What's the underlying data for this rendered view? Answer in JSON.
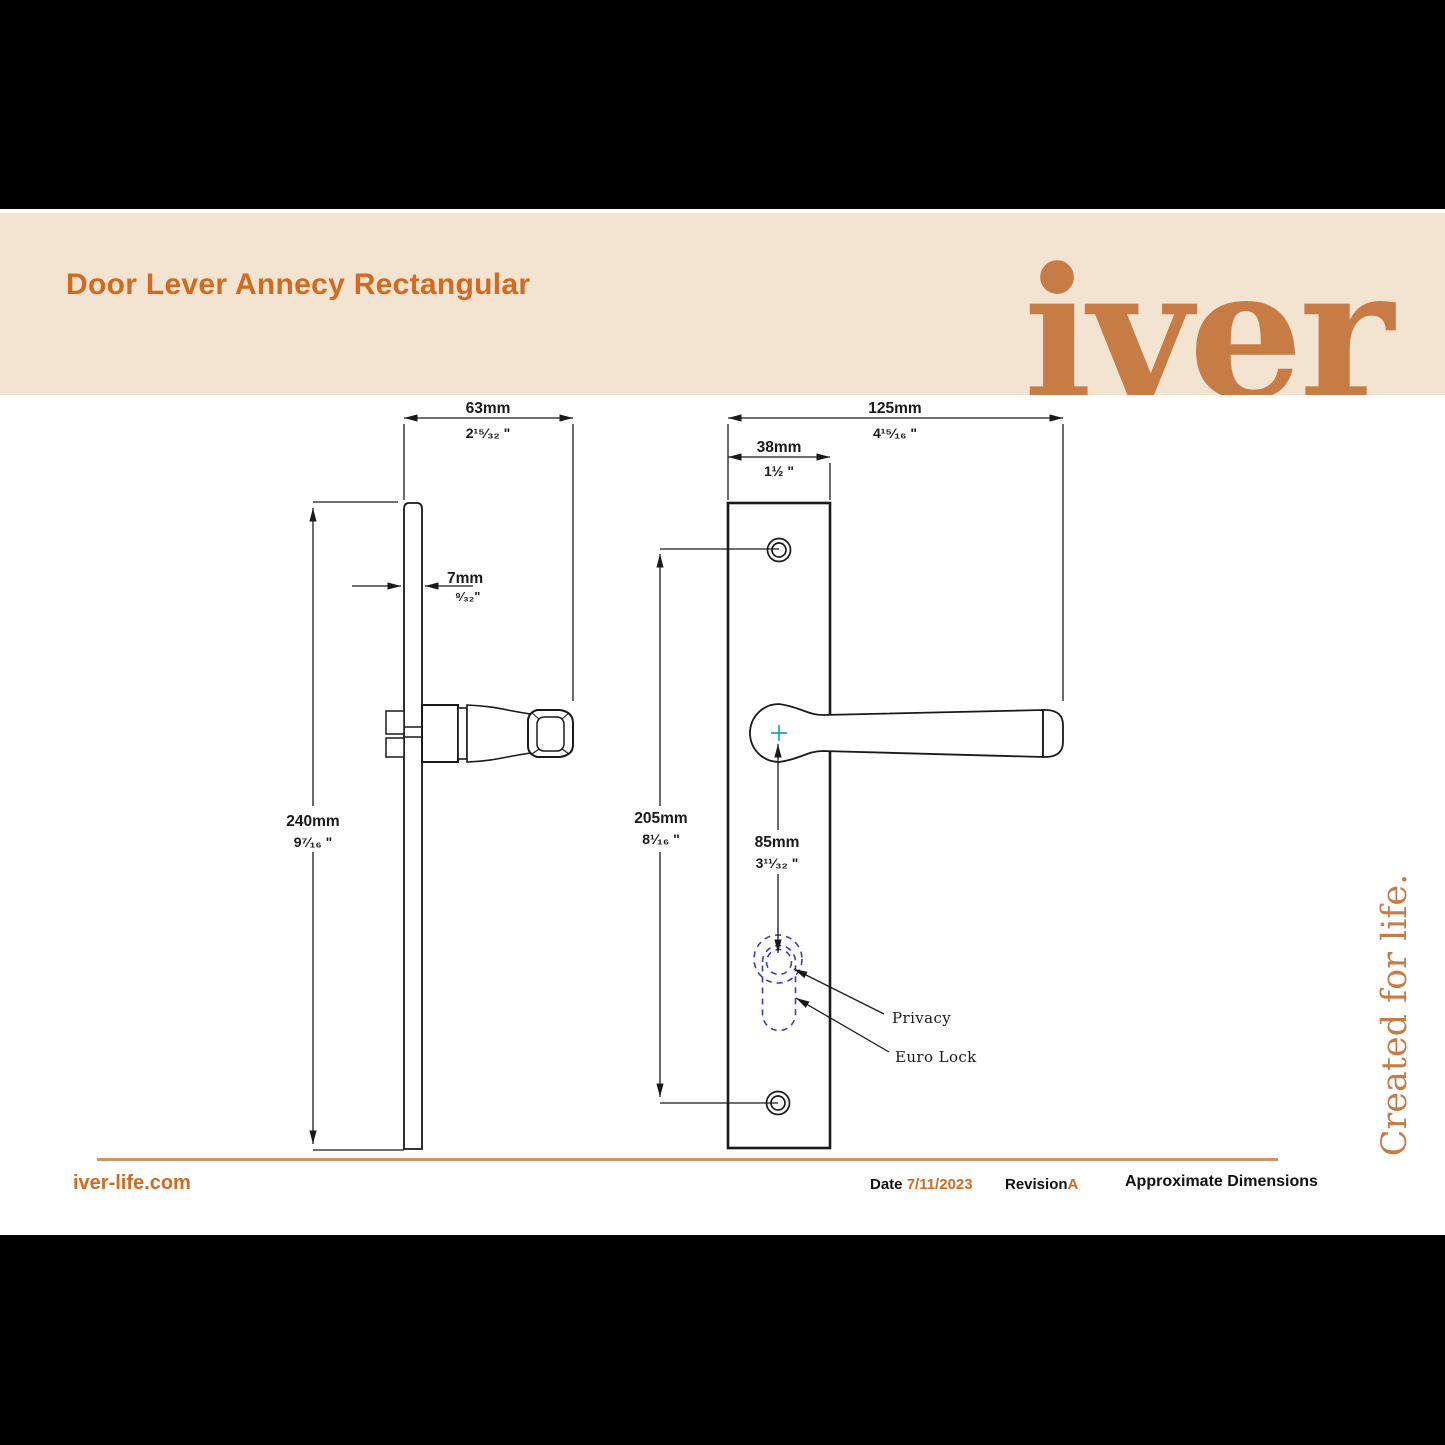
{
  "header": {
    "title": "Door Lever Annecy Rectangular",
    "logo_text": "iver"
  },
  "tagline": "Created for life.",
  "dims": {
    "d63": {
      "mm": "63mm",
      "in": "2¹⁵⁄₃₂ \""
    },
    "d7": {
      "mm": "7mm",
      "in": "⁹⁄₃₂\""
    },
    "d240": {
      "mm": "240mm",
      "in": "9⁷⁄₁₆ \""
    },
    "d125": {
      "mm": "125mm",
      "in": "4¹⁵⁄₁₆ \""
    },
    "d38": {
      "mm": "38mm",
      "in": "1½ \""
    },
    "d205": {
      "mm": "205mm",
      "in": "8¹⁄₁₆ \""
    },
    "d85": {
      "mm": "85mm",
      "in": "3¹¹⁄₃₂ \""
    }
  },
  "callouts": {
    "privacy": "Privacy",
    "euro_lock": "Euro Lock"
  },
  "footer": {
    "website": "iver-life.com",
    "date_label": "Date",
    "date_value": "7/11/2023",
    "revision_label": "Revision",
    "revision_value": "A",
    "note": "Approximate Dimensions"
  },
  "colors": {
    "accent": "#D26A1F",
    "logo_orange": "#C87C45",
    "cream_band": "#F3E3D1",
    "footer_rule": "#CE9668",
    "keyhole_blue": "#3D3DB8",
    "cross_teal": "#1FA8B8",
    "ink": "#1A1A1A"
  }
}
